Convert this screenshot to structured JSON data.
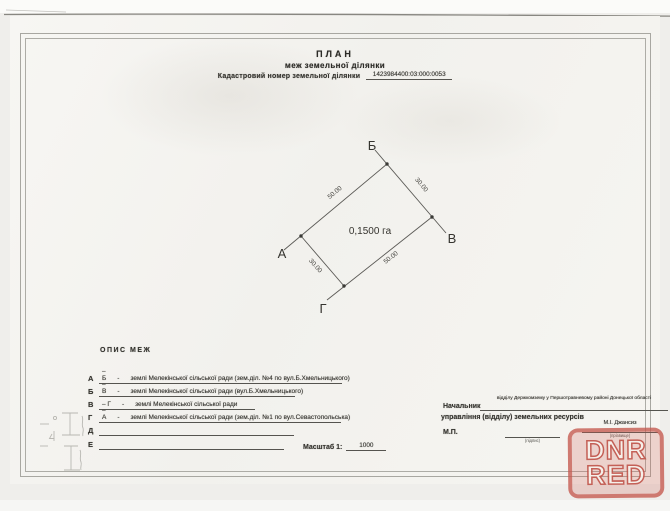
{
  "document": {
    "title": "ПЛАН",
    "subtitle": "меж земельної ділянки",
    "cadastral_label": "Кадастровий номер земельної ділянки",
    "cadastral_number": "1423984400:03:000:0053"
  },
  "plot": {
    "area": "0,1500 га",
    "vertex_labels": {
      "a": "А",
      "b": "Б",
      "v": "В",
      "g": "Г"
    },
    "side_lengths": {
      "ab": "50.00",
      "bv": "30.00",
      "vg": "50.00",
      "ga": "30.00"
    }
  },
  "boundaries": {
    "heading": "ОПИС МЕЖ",
    "rows": [
      {
        "letter": "А",
        "segment": "– Б",
        "sep": "-",
        "description": "землі Мелекінської сільської ради (зем.діл. №4 по вул.Б.Хмельницького)"
      },
      {
        "letter": "Б",
        "segment": "– В",
        "sep": "-",
        "description": "землі Мелекінської сільської ради (вул.Б.Хмельницького)"
      },
      {
        "letter": "В",
        "segment": "– Г",
        "sep": "-",
        "description": "землі Мелекінської сільської ради"
      },
      {
        "letter": "Г",
        "segment": "– А",
        "sep": "-",
        "description": "землі Мелекінської сільської ради (зем.діл. №1 по вул.Севастопольська)"
      },
      {
        "letter": "Д",
        "segment": "",
        "sep": "",
        "description": ""
      },
      {
        "letter": "Е",
        "segment": "",
        "sep": "",
        "description": ""
      }
    ]
  },
  "approval": {
    "chief_label": "Начальник",
    "chief_department": "відділу Держкомзему у Першотравневому районі Донецької області",
    "chief_label_line2": "управління (відділу) земельних ресурсів",
    "seal_label": "М.П.",
    "signature_caption": "(підпис)",
    "signatory_name": "М.І. Джансиз",
    "signatory_caption": "(прізвище)"
  },
  "scale": {
    "label": "Масштаб 1:",
    "value": "1000"
  },
  "watermark": {
    "line1": "DNR",
    "line2": "RED",
    "color": "#c4574d"
  }
}
